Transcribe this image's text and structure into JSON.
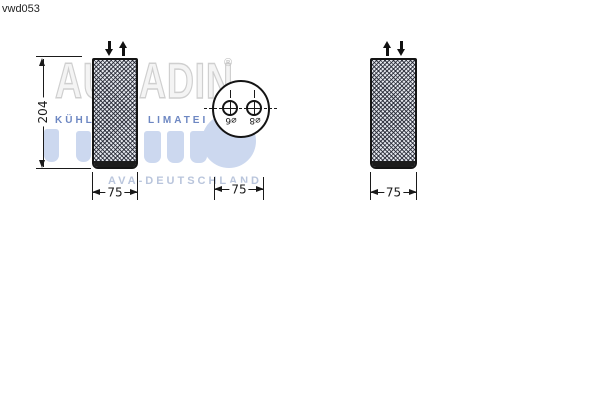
{
  "part_code": "vwd053",
  "watermark": {
    "brand_fragment_left": "AU",
    "brand_fragment_right": "ADIN",
    "registered_mark": "®",
    "tagline_fragment_left": "KÜHL",
    "tagline_fragment_right": "LIMATEI",
    "footer_text": "AVA-DEUTSCHLAND",
    "colors": {
      "brand_outline": "#cfcfcf",
      "tagline_blue": "#6d87c2",
      "logo_shape_blue": "#ccd8ef",
      "footer_blue": "#b9c5dc"
    }
  },
  "views": {
    "front": {
      "height_dimension": "204",
      "width_dimension": "75"
    },
    "top": {
      "port_left_label": "⌀6",
      "port_right_label": "⌀8",
      "width_dimension": "75"
    },
    "side": {
      "width_dimension": "75"
    }
  },
  "drawing_color": "#1a1a1a"
}
